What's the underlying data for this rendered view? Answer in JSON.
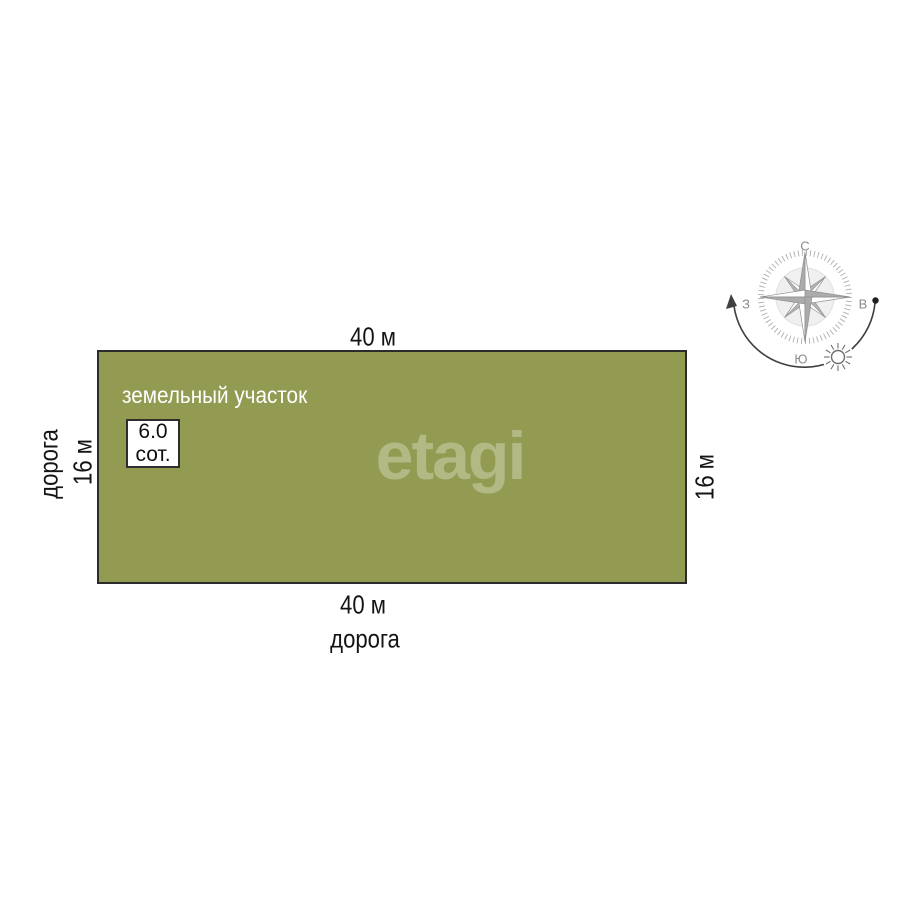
{
  "plot": {
    "name_label": "земельный участок",
    "area_value": "6.0",
    "area_unit": "сот.",
    "fill_color": "#929b51",
    "border_color": "#2b2b2b"
  },
  "dimensions": {
    "top_width": "40 м",
    "bottom_width": "40 м",
    "left_height": "16 м",
    "right_height": "16 м"
  },
  "roads": {
    "left_label": "дорога",
    "bottom_label": "дорога"
  },
  "watermark": {
    "text": "etagi",
    "color": "rgba(255,255,255,0.3)"
  },
  "compass": {
    "north_label": "С",
    "south_label": "Ю",
    "west_label": "З",
    "east_label": "В",
    "icons": [
      "compass-rose-icon",
      "sun-icon",
      "sun-path-arrow-icon"
    ]
  }
}
